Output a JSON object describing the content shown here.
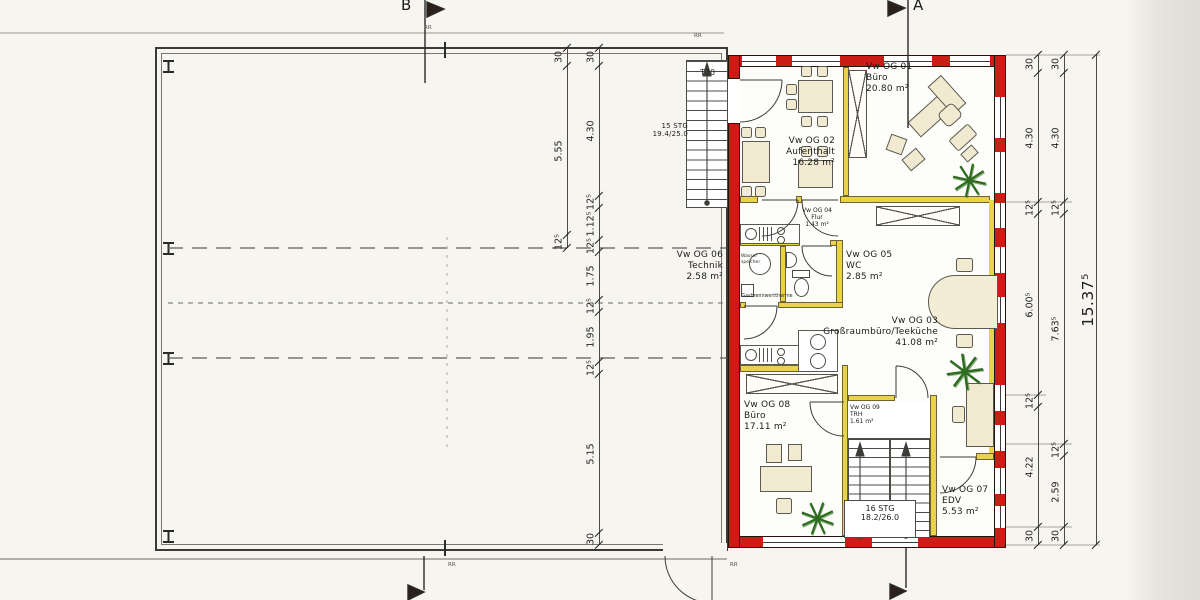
{
  "colors": {
    "wall_red": "#c91d15",
    "wall_yellow": "#e8d34a",
    "furniture": "#f1ead0",
    "paper": "#f7f5ef",
    "plant_green": "#2e6d20"
  },
  "markers": {
    "section_a": "A",
    "section_b": "B",
    "roof": "RR",
    "fire_door": "T30"
  },
  "rooms": [
    {
      "id": "Vw OG 01",
      "name": "Büro",
      "area": "20.80 m²"
    },
    {
      "id": "Vw OG 02",
      "name": "Aufenthalt",
      "area": "16.28 m²"
    },
    {
      "id": "Vw OG 03",
      "name": "Großraumbüro/Teeküche",
      "area": "41.08 m²"
    },
    {
      "id": "Vw OG 04",
      "name": "Flur",
      "area": "1.43 m²"
    },
    {
      "id": "Vw OG 05",
      "name": "WC",
      "area": "2.85 m²"
    },
    {
      "id": "Vw OG 06",
      "name": "Technik",
      "area": "2.58 m²"
    },
    {
      "id": "Vw OG 07",
      "name": "EDV",
      "area": "5.53 m²"
    },
    {
      "id": "Vw OG 08",
      "name": "Büro",
      "area": "17.11 m²"
    },
    {
      "id": "Vw OG 09",
      "name": "TRH",
      "area": "1.61 m²"
    }
  ],
  "stairs": {
    "external": {
      "line1": "15 STG",
      "line2": "19.4/25.0"
    },
    "internal": {
      "line1": "16 STG",
      "line2": "18.2/26.0"
    }
  },
  "equipment": {
    "tank_line1": "Wasser",
    "tank_line2": "speicher",
    "boiler": "Gasbrennwerttherme"
  },
  "plants": {
    "glyph": "✳"
  },
  "dimensions": {
    "left_outer": [
      "30",
      "5.55",
      "12⁵"
    ],
    "left_inner": [
      "30",
      "4.30",
      "12⁵",
      "1.12⁵",
      "12⁵",
      "1.75",
      "12⁵",
      "1.95",
      "12⁵",
      "5.15",
      "30"
    ],
    "right_inner": [
      "30",
      "4.30",
      "12⁵",
      "6.00⁵",
      "12⁵",
      "4.22",
      "30"
    ],
    "right_mid": [
      "30",
      "4.30",
      "12⁵",
      "7.63⁵",
      "12⁵",
      "2.59",
      "30"
    ],
    "right_total": [
      "15.37⁵"
    ]
  }
}
